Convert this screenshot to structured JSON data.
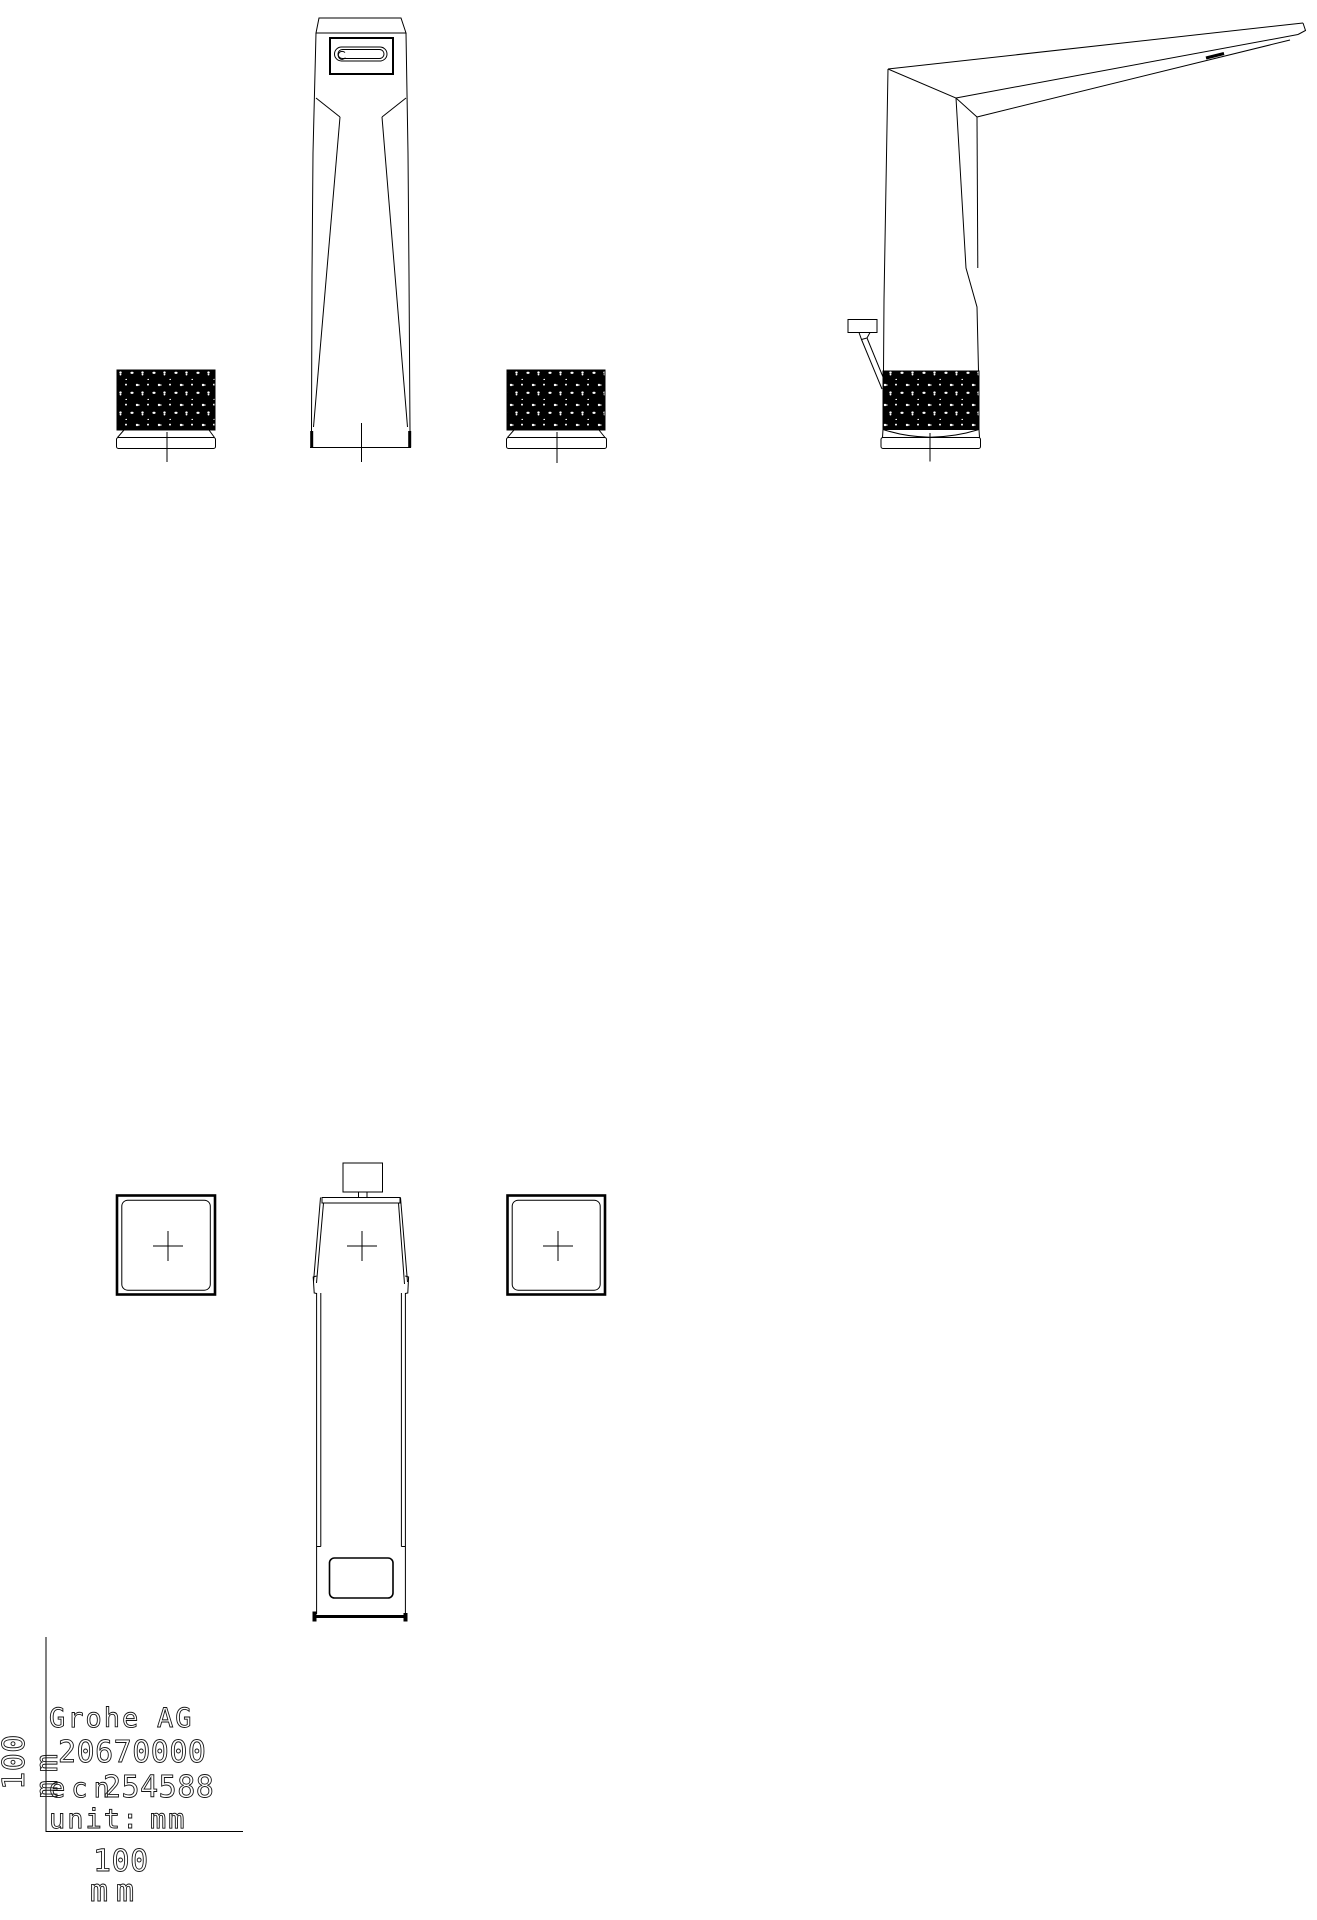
{
  "meta": {
    "background_color": "#ffffff",
    "line_color": "#000000",
    "knurl_fill_color": "#000000"
  },
  "title_block": {
    "brand": "Grohe",
    "brand_suffix": "AG",
    "product_number": "20670000",
    "ecn_label": "ecn",
    "ecn_number": "254588",
    "unit_label": "unit:",
    "unit_value": "mm",
    "vertical_scale_value": "100",
    "vertical_scale_unit": "mm",
    "horizontal_scale_value": "100",
    "horizontal_scale_unit": "mm"
  }
}
